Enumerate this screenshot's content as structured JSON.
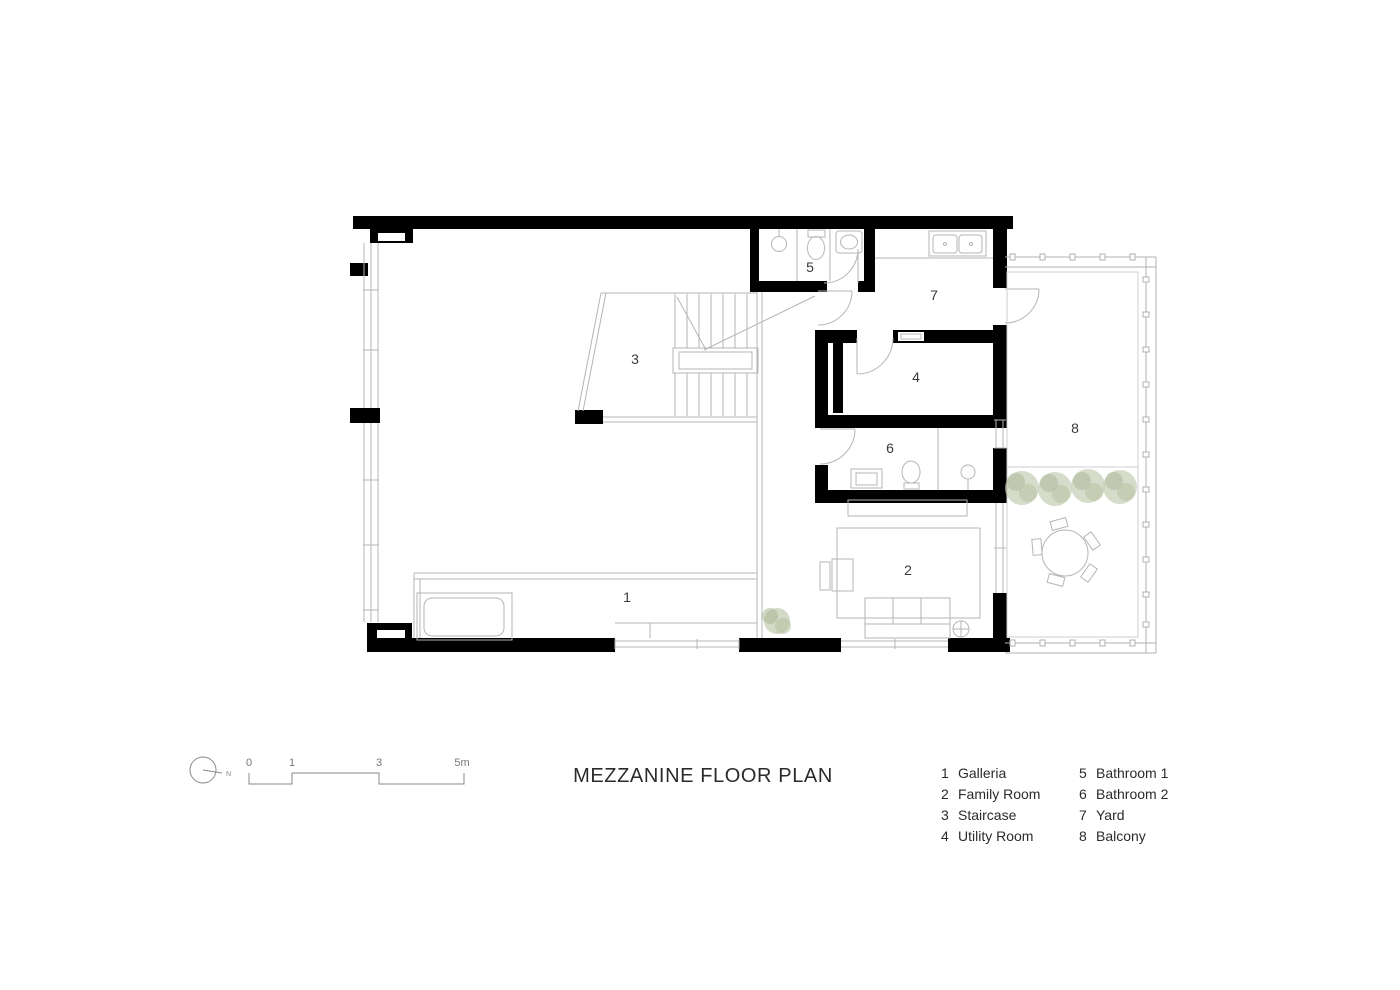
{
  "title": "MEZZANINE FLOOR PLAN",
  "north": {
    "label": "N"
  },
  "scale_bar": {
    "labels": [
      "0",
      "1",
      "3",
      "5m"
    ]
  },
  "plan": {
    "room_labels": [
      {
        "number": "1",
        "name": "Galleria"
      },
      {
        "number": "2",
        "name": "Family Room"
      },
      {
        "number": "3",
        "name": "Staircase"
      },
      {
        "number": "4",
        "name": "Utility Room"
      },
      {
        "number": "5",
        "name": "Bathroom 1"
      },
      {
        "number": "6",
        "name": "Bathroom 2"
      },
      {
        "number": "7",
        "name": "Yard"
      },
      {
        "number": "8",
        "name": "Balcony"
      }
    ]
  },
  "legend": {
    "col1": [
      {
        "number": "1",
        "label": "Galleria"
      },
      {
        "number": "2",
        "label": "Family Room"
      },
      {
        "number": "3",
        "label": "Staircase"
      },
      {
        "number": "4",
        "label": "Utility Room"
      }
    ],
    "col2": [
      {
        "number": "5",
        "label": "Bathroom 1"
      },
      {
        "number": "6",
        "label": "Bathroom 2"
      },
      {
        "number": "7",
        "label": "Yard"
      },
      {
        "number": "8",
        "label": "Balcony"
      }
    ]
  },
  "colors": {
    "wall": "#000000",
    "thin_line": "#b5b5b5",
    "railing": "#b0b0b0",
    "text": "#2b2b2b",
    "tree_fill": "#c5cdb4"
  }
}
